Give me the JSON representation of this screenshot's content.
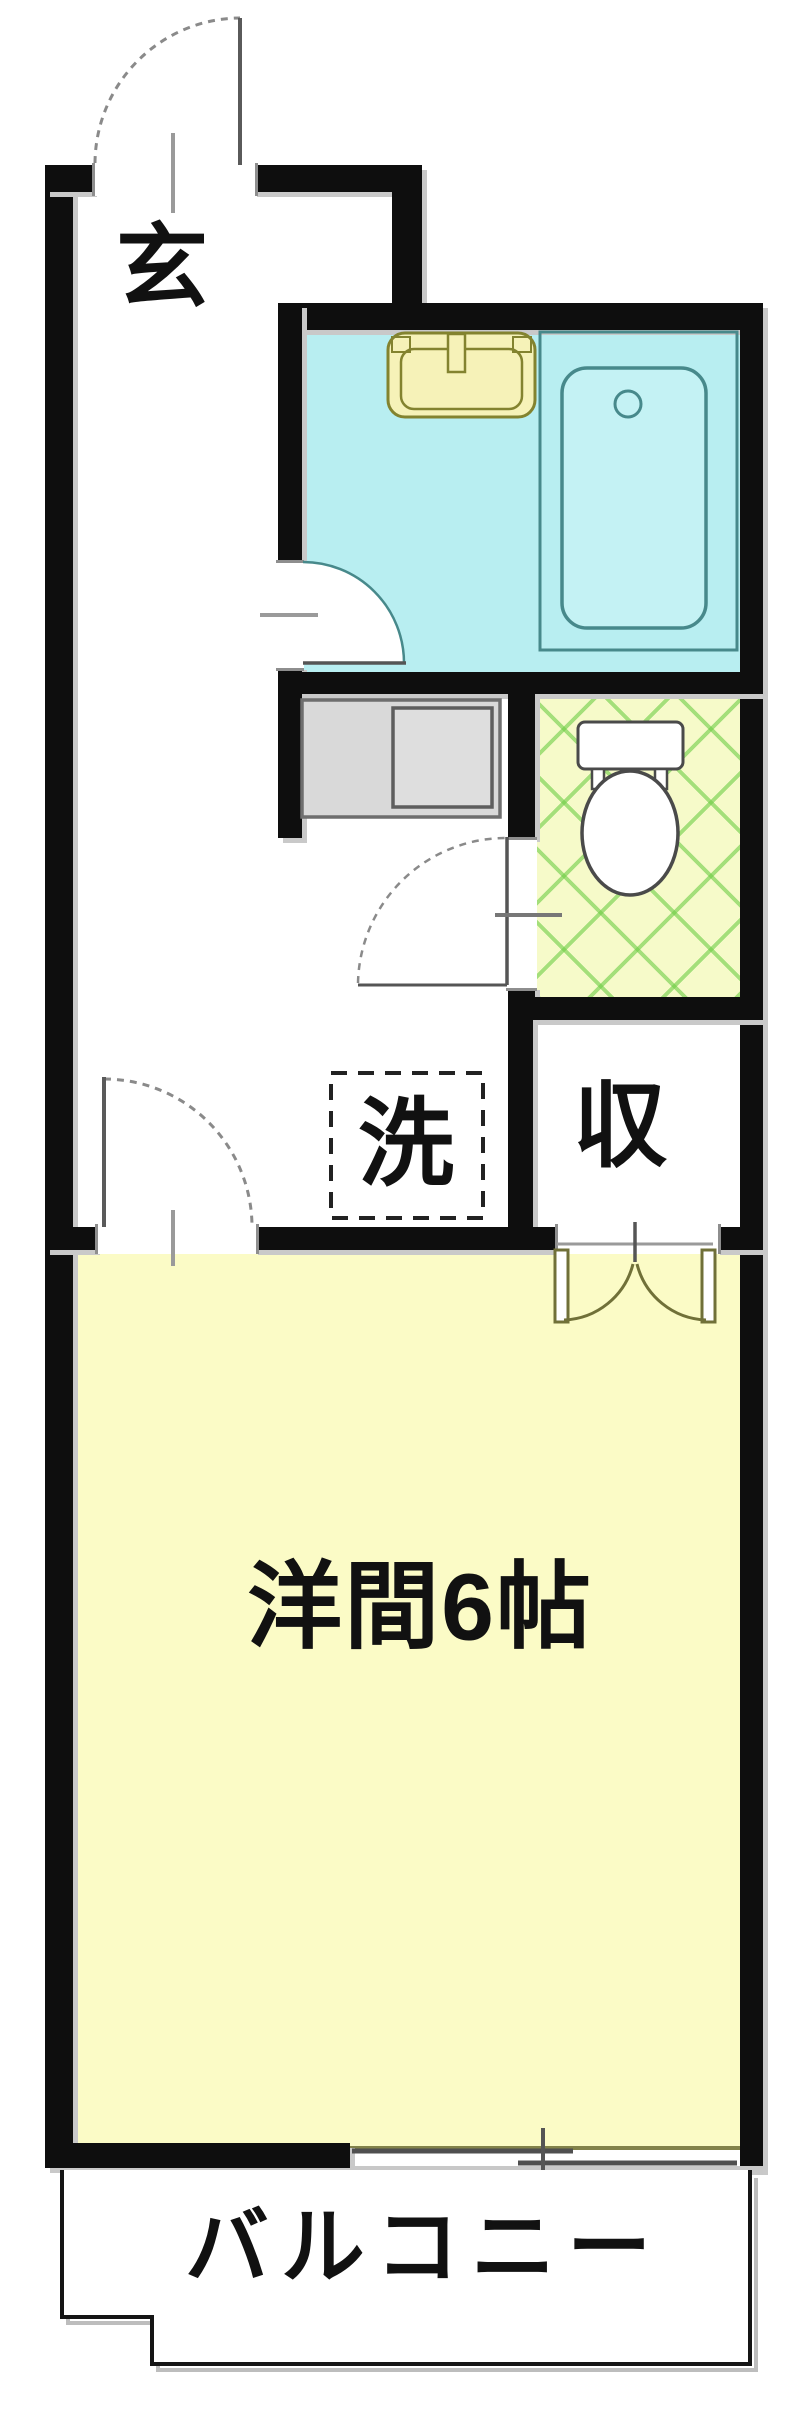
{
  "floorplan": {
    "kind": "japanese-apartment-floor-plan",
    "labels": {
      "entrance": "玄",
      "laundry": "洗",
      "storage": "収",
      "main_room": "洋間6帖",
      "balcony": "バルコニー"
    },
    "rooms": [
      {
        "name": "entrance-hall",
        "label": "玄"
      },
      {
        "name": "bathroom",
        "label": ""
      },
      {
        "name": "toilet-room",
        "label": ""
      },
      {
        "name": "laundry-space",
        "label": "洗"
      },
      {
        "name": "storage-closet",
        "label": "収"
      },
      {
        "name": "western-room-6-tatami",
        "label": "洋間6帖"
      },
      {
        "name": "balcony",
        "label": "バルコニー"
      }
    ],
    "fixtures": [
      "entrance-swing-door",
      "bathroom-sink",
      "bathtub",
      "bathroom-swing-door",
      "kitchen-counter-unit",
      "toilet",
      "toilet-swing-door",
      "washing-machine-pan",
      "closet-double-doors",
      "room-swing-door",
      "sliding-window",
      "balcony-outline"
    ],
    "colors": {
      "wall": "#0e0e0e",
      "bathroom_floor": "#b8eef1",
      "bathtub_stroke": "#47898b",
      "bathtub_fill": "#c4f2f4",
      "sink_fill": "#f6f2b8",
      "sink_stroke": "#83832f",
      "toilet_floor": "#f6fac9",
      "toilet_lattice": "#6ecd46",
      "counter_fill": "#d9d9d9",
      "main_room_floor": "#fbfbc6",
      "balcony_outline": "#151515",
      "text": "#111111"
    }
  }
}
